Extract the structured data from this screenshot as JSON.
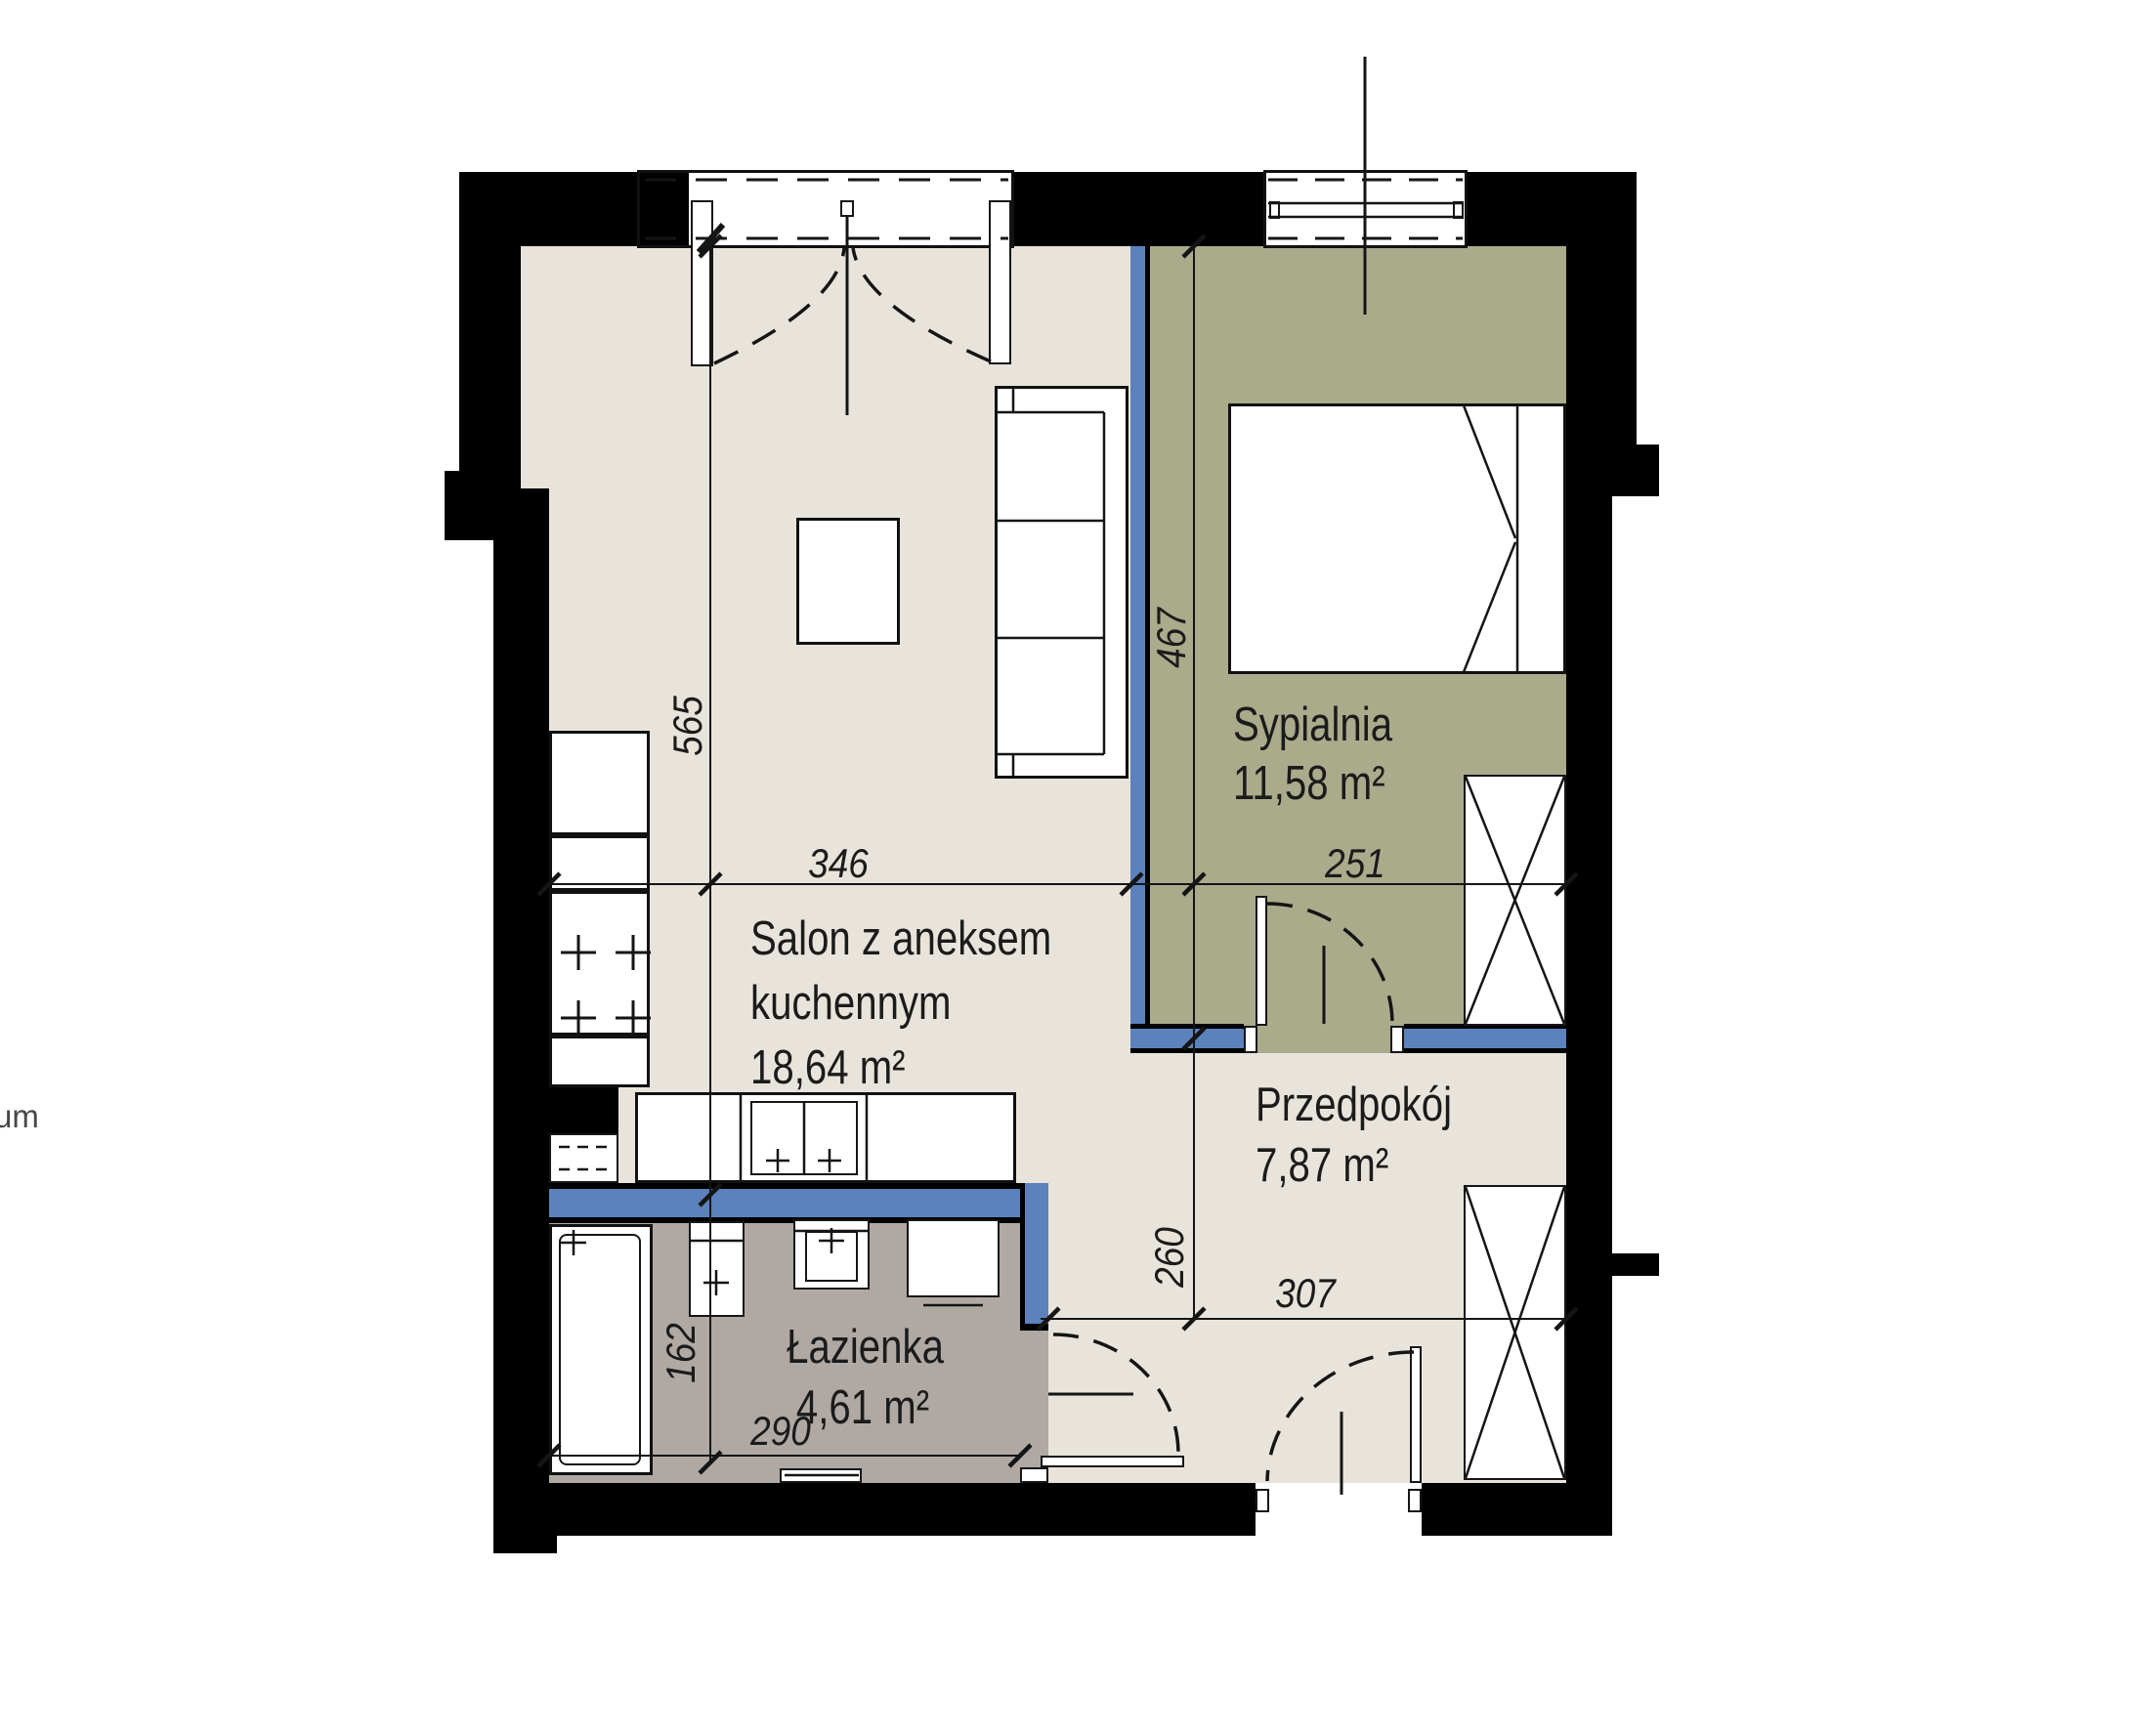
{
  "watermark": {
    "text": "um"
  },
  "colors": {
    "wall": "#000000",
    "accent_wall_blue": "#5b82bd",
    "floor_living": "#e8e4db",
    "floor_bedroom": "#a9ab8b",
    "floor_bathroom": "#b0a9a3",
    "line": "#151515",
    "text": "#1b1b1b"
  },
  "rooms": [
    {
      "id": "salon",
      "name_line1": "Salon z aneksem",
      "name_line2": "kuchennym",
      "area": "18,64 m²"
    },
    {
      "id": "sypialnia",
      "name": "Sypialnia",
      "area": "11,58 m²"
    },
    {
      "id": "przedpokoj",
      "name": "Przedpokój",
      "area": "7,87 m²"
    },
    {
      "id": "lazienka",
      "name": "Łazienka",
      "area": "4,61 m²"
    }
  ],
  "dimensions_cm": {
    "salon_height": "565",
    "salon_width": "346",
    "bedroom_height": "467",
    "bedroom_width": "251",
    "hall_height": "260",
    "hall_width": "307",
    "bath_height": "162",
    "bath_width": "290"
  }
}
